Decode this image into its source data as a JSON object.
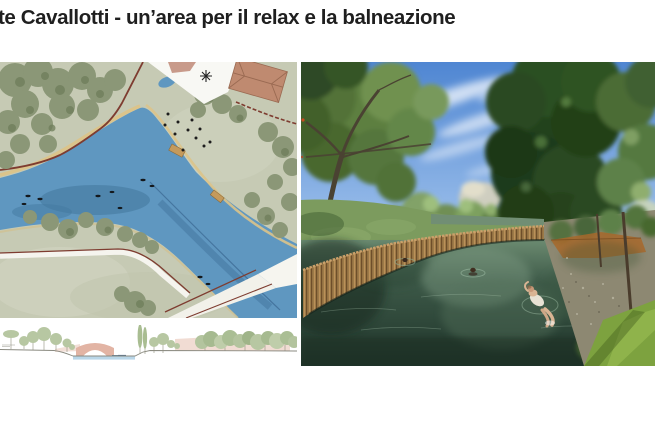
{
  "slide": {
    "title": "te Cavallotti - un’area per il relax e la balneazione"
  },
  "palette": {
    "title_color": "#1f1f1f",
    "plan_land": "#c6cab4",
    "plan_land_light": "#d3d6c2",
    "plan_water": "#5f97c0",
    "plan_water_deep": "#44799f",
    "plan_tree": "#8b9777",
    "plan_tree_dark": "#6e7d5a",
    "plan_path_red": "#7e3c30",
    "plan_sand": "#dcc389",
    "plan_roof": "#bf8a70",
    "section_water": "#b9d6e8",
    "section_tree": "#b7c7a2",
    "section_pink": "#e9c9bc",
    "section_ground": "#8a8a80",
    "photo_sky": "#4f86d2",
    "photo_sky_light": "#a9c9ef",
    "photo_tree": "#4c6c36",
    "photo_tree_dark": "#24421e",
    "photo_water": "#3c5847",
    "photo_water_dark": "#1f342a",
    "photo_wall": "#9c7a48",
    "photo_wall_dark": "#6e4e2a",
    "photo_grass": "#7da23f",
    "photo_bank": "#8d8872",
    "photo_skin": "#d9b493"
  }
}
